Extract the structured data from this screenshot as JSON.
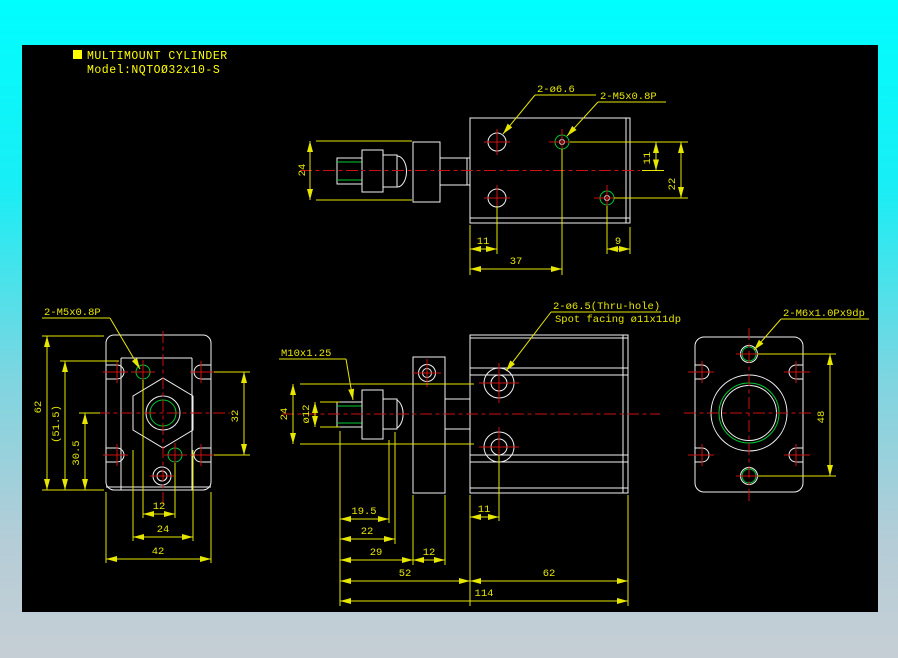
{
  "colors": {
    "background_top": "#00feff",
    "background_bottom": "#c6ced5",
    "canvas": "#000000",
    "outline": "#f2f2f2",
    "dimension": "#e6e600",
    "centerline": "#cc1111",
    "thread": "#00c832",
    "title": "#ffff00"
  },
  "title": {
    "product": "MULTIMOUNT CYLINDER",
    "model": "Model:NQTOØ32x10-S"
  },
  "top_view": {
    "leader_hole": "2-ø6.6",
    "leader_tap": "2-M5x0.8P",
    "dim_depth": "24",
    "dim_hole_offset": "11",
    "dim_hole_span": "22",
    "dim_edge_left": "11",
    "dim_edge_right": "9",
    "dim_span": "37"
  },
  "left_view": {
    "leader_tap": "2-M5x0.8P",
    "dim_height": "62",
    "dim_ref_height": "(51.5)",
    "dim_center_bottom": "30.5",
    "dim_tap_offset": "12",
    "dim_hex": "24",
    "dim_width": "42",
    "dim_slot_span": "32"
  },
  "front_view": {
    "leader_rod_thread": "M10x1.25",
    "leader_thru_hole_line1": "2-ø6.5(Thru-hole)",
    "leader_thru_hole_line2": "Spot facing ø11x11dp",
    "dim_rod_mount": "24",
    "dim_rod_dia": "ø12",
    "dim_thread_len": "19.5",
    "dim_rod_ext": "22",
    "dim_to_bracket": "29",
    "dim_bracket_thk": "12",
    "dim_hole_inset": "11",
    "dim_head_len": "52",
    "dim_body_len": "62",
    "dim_total_len": "114"
  },
  "right_view": {
    "leader_tap": "2-M6x1.0Px9dp",
    "dim_tap_span": "48"
  }
}
